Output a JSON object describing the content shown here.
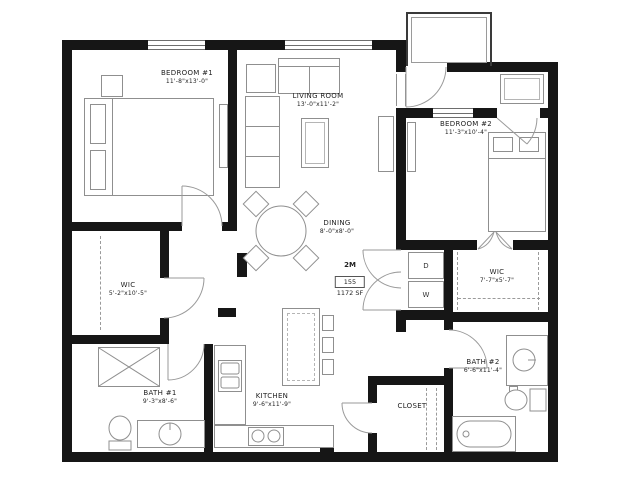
{
  "unit": {
    "type": "2M",
    "number": "155",
    "area": "1172 SF"
  },
  "rooms": {
    "bedroom1": {
      "name": "BEDROOM #1",
      "dims": "11'-8\"x13'-0\""
    },
    "living": {
      "name": "LIVING ROOM",
      "dims": "13'-0\"x11'-2\""
    },
    "bedroom2": {
      "name": "BEDROOM #2",
      "dims": "11'-3\"x10'-4\""
    },
    "dining": {
      "name": "DINING",
      "dims": "8'-0\"x8'-0\""
    },
    "wic1": {
      "name": "WIC",
      "dims": "5'-2\"x10'-5\""
    },
    "wic2": {
      "name": "WIC",
      "dims": "7'-7\"x5'-7\""
    },
    "bath1": {
      "name": "BATH #1",
      "dims": "9'-3\"x8'-6\""
    },
    "kitchen": {
      "name": "KITCHEN",
      "dims": "9'-6\"x11'-9\""
    },
    "bath2": {
      "name": "BATH #2",
      "dims": "6'-6\"x11'-4\""
    },
    "closet": {
      "name": "CLOSET"
    }
  },
  "laundry": {
    "dryer_label": "D",
    "washer_label": "W"
  },
  "colors": {
    "wall": "#161616",
    "line": "#8f8f8f",
    "text": "#1f1f1f",
    "bg": "#ffffff"
  }
}
